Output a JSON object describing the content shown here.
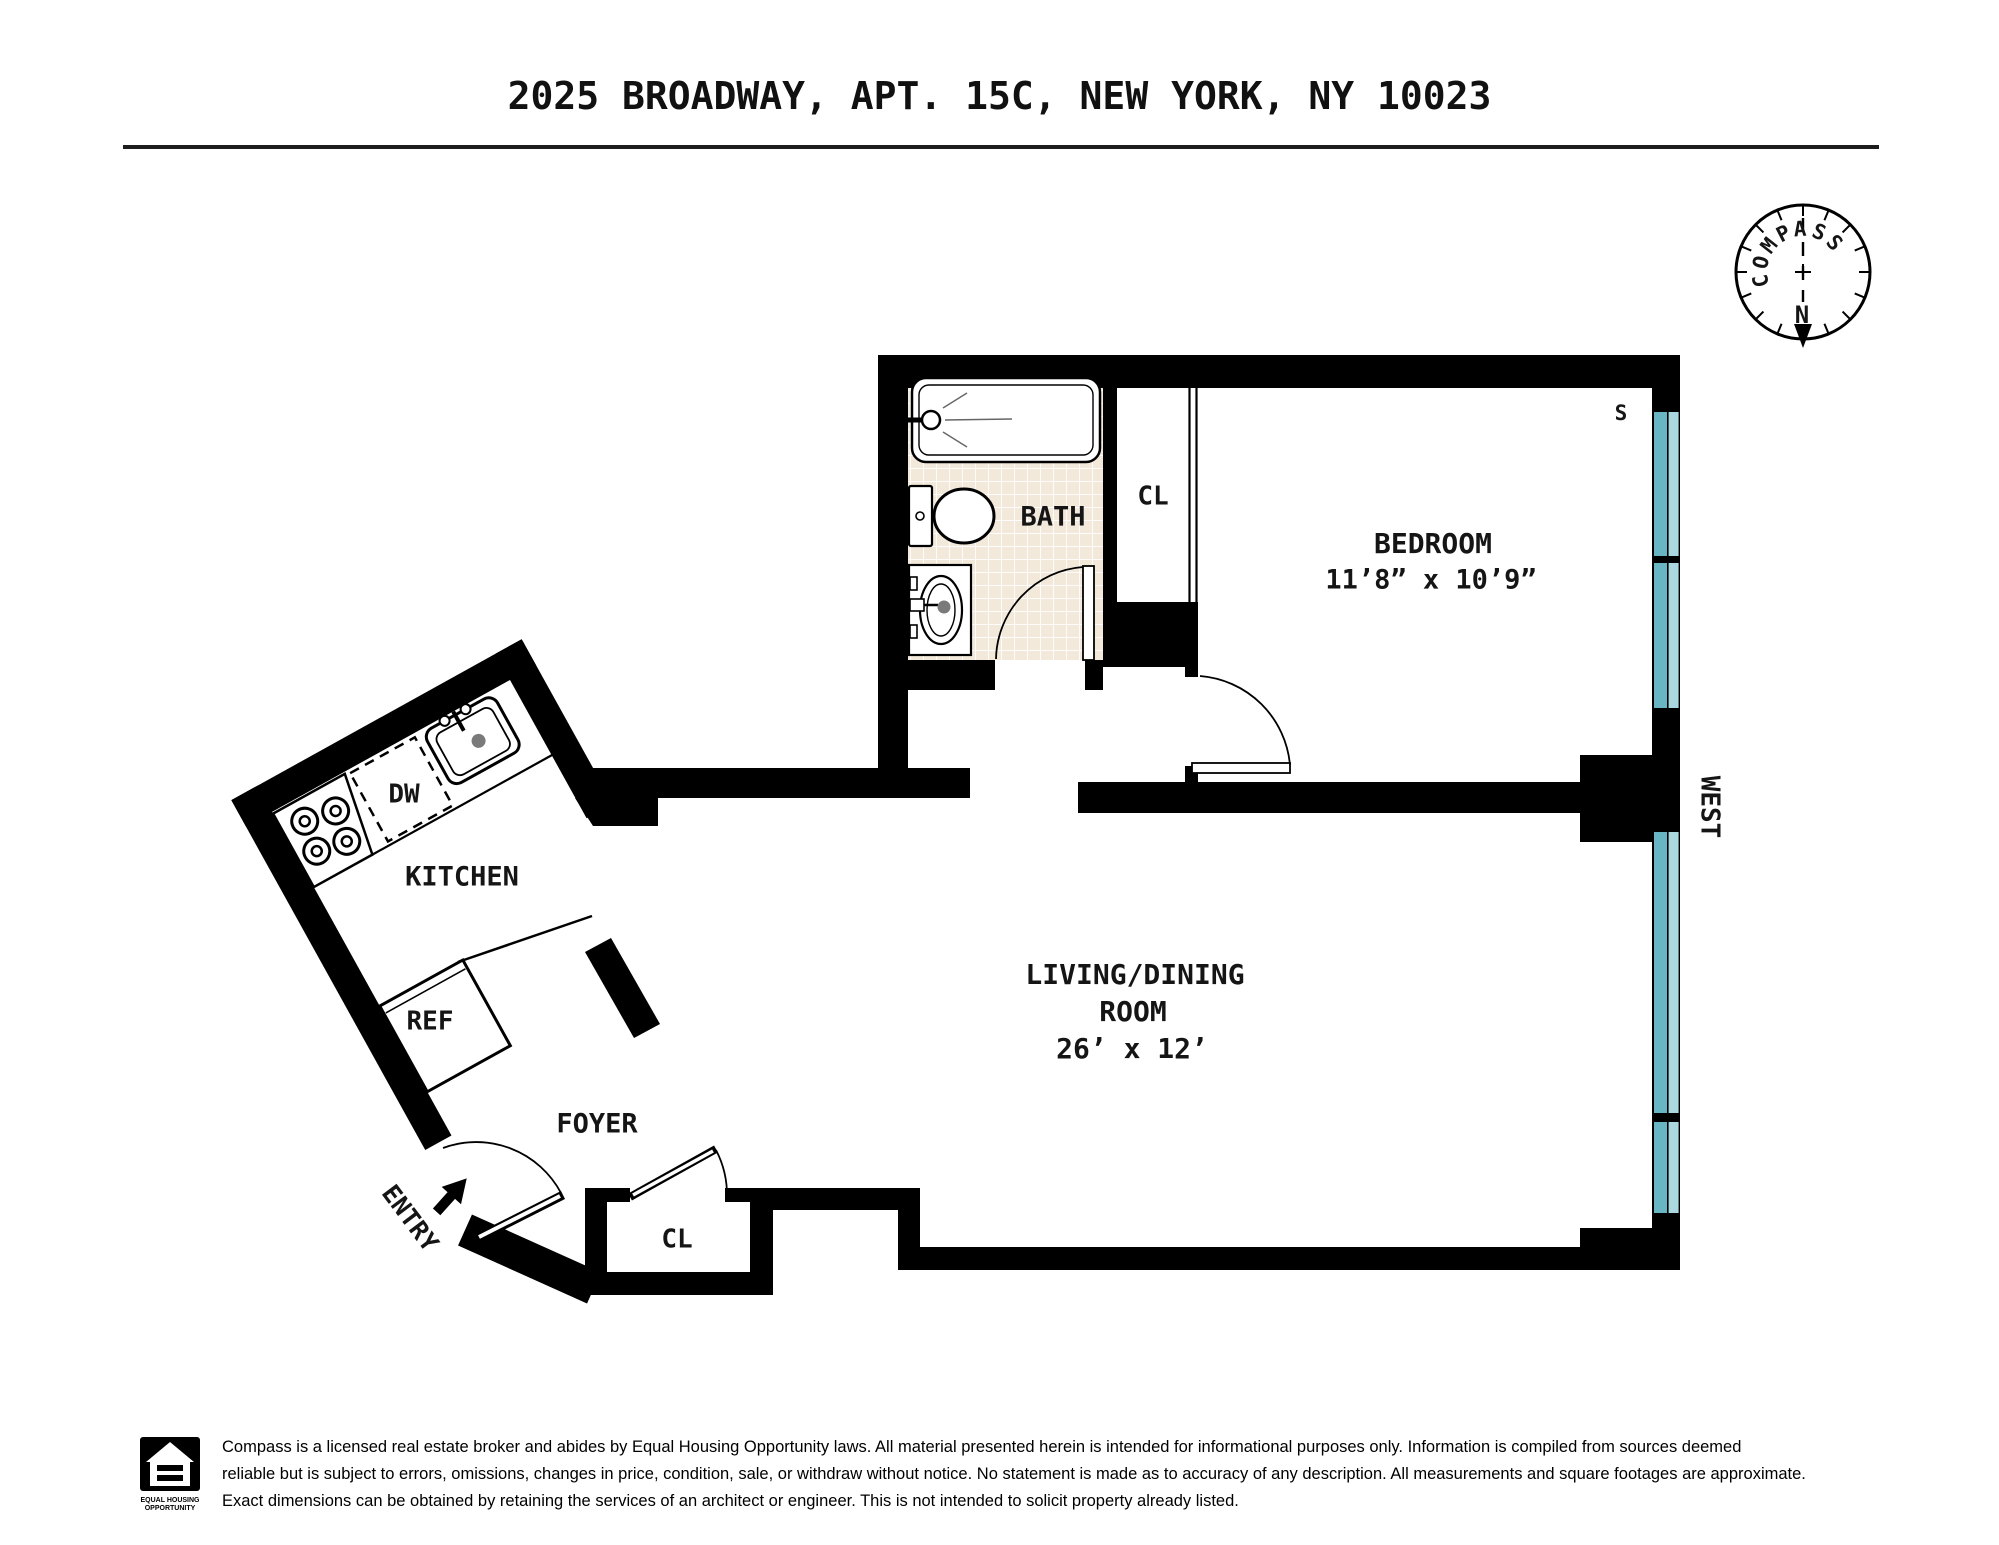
{
  "title": "2025 BROADWAY, APT. 15C, NEW YORK, NY 10023",
  "compass": {
    "letters": [
      "C",
      "O",
      "M",
      "P",
      "A",
      "S",
      "S"
    ],
    "north": "N"
  },
  "orientation": {
    "west": "WEST",
    "south_marker": "S"
  },
  "rooms": {
    "bath": "BATH",
    "bath_closet": "CL",
    "bedroom": "BEDROOM",
    "bedroom_dims": "11’8” x 10’9”",
    "kitchen": "KITCHEN",
    "dishwasher": "DW",
    "refrigerator": "REF",
    "foyer": "FOYER",
    "entry": "ENTRY",
    "foyer_closet": "CL",
    "living_line1": "LIVING/DINING",
    "living_line2": "ROOM",
    "living_dims": "26’ x 12’"
  },
  "colors": {
    "wall": "#000000",
    "window_dark": "#68b6c3",
    "window_light": "#abd7de",
    "tile": "#f2e9da",
    "north_red": "#e0191c"
  },
  "footer": {
    "eho_line1": "EQUAL HOUSING",
    "eho_line2": "OPPORTUNITY",
    "line1": "Compass is a licensed real estate broker and abides by Equal Housing Opportunity laws. All material presented herein is intended for informational purposes only. Information is compiled from sources deemed",
    "line2": "reliable but is subject to errors, omissions, changes in price, condition, sale, or withdraw without notice. No statement is made as to accuracy of any description. All measurements and square footages are approximate.",
    "line3": "Exact dimensions can be obtained by retaining the services of an architect or engineer. This is not intended to solicit property already listed."
  }
}
